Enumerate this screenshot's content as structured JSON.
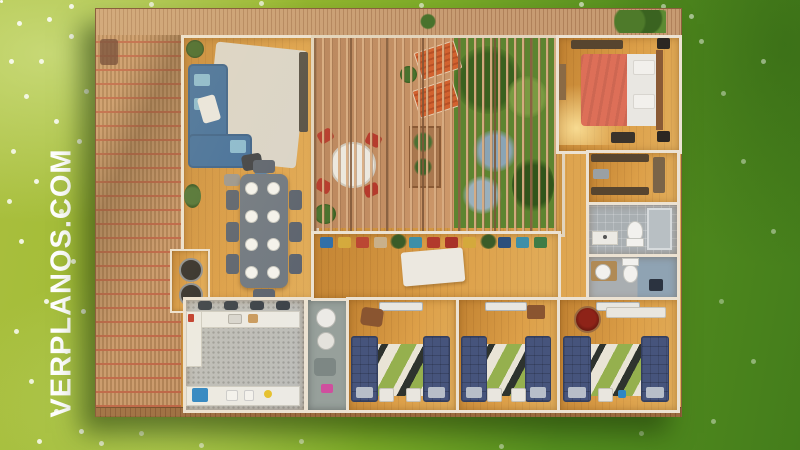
{
  "watermark": {
    "text": "VERPLANOS.COM",
    "color": "#ffffff"
  },
  "scene": {
    "type": "aerial-3d-floor-plan-render",
    "setting": "green lawn with white wildflowers, brighter yellow-green at left, darker green at right",
    "house": {
      "exterior_features": [
        "slatted wood deck strip along top",
        "terracotta trellis pergola deck on left",
        "rear wood deck edge along bottom",
        "central courtyard covered by wood slat pergola with garden"
      ],
      "rooms": [
        {
          "name": "living-room",
          "contents": [
            "blue L-shaped sofa",
            "light area rug",
            "tv wall unit",
            "dark armchair",
            "potted plants"
          ]
        },
        {
          "name": "dining-area",
          "contents": [
            "gray rectangular table",
            "8 white place settings",
            "8 gray chairs",
            "potted plants",
            "bbq nook with grill"
          ]
        },
        {
          "name": "kitchen",
          "contents": [
            "terrazzo floor",
            "white L-shaped counter",
            "4 dark bar stools",
            "bottom counter with blue cabinet",
            "small appliances"
          ]
        },
        {
          "name": "laundry-bathroom",
          "contents": [
            "white round fixtures",
            "pink towel"
          ]
        },
        {
          "name": "courtyard",
          "contents": [
            "2 orange sun loungers",
            "round white table with 4 red chairs",
            "wood planter",
            "lush garden with blue-gray flowering shrubs"
          ]
        },
        {
          "name": "hallway",
          "contents": [
            "bench with multicolor cushions",
            "white runner rug",
            "potted plants"
          ]
        },
        {
          "name": "master-bedroom",
          "contents": [
            "double bed with coral blanket and white duvet",
            "wood headboard",
            "2 dark nightstands",
            "wardrobe",
            "bench",
            "floor lamp glow"
          ]
        },
        {
          "name": "walk-in-closet",
          "contents": [
            "dark wardrobes",
            "gray bench"
          ]
        },
        {
          "name": "bathroom-1",
          "contents": [
            "sink counter",
            "toilet",
            "glass shower"
          ]
        },
        {
          "name": "bathroom-2",
          "contents": [
            "round sink",
            "toilet",
            "blue tiled shower corner",
            "dark floor drain"
          ]
        },
        {
          "name": "bedroom-1",
          "contents": [
            "2 navy single beds",
            "geometric rug",
            "brown pouf",
            "2 small desks",
            "ac unit"
          ]
        },
        {
          "name": "bedroom-2",
          "contents": [
            "2 navy single beds",
            "geometric rug",
            "brown cabinet",
            "2 small desks",
            "ac unit"
          ]
        },
        {
          "name": "bedroom-3",
          "contents": [
            "2 navy single beds",
            "geometric rug",
            "dark red round chair",
            "white shelf desk",
            "ac unit"
          ]
        }
      ]
    },
    "palette": {
      "grass_light": "#9cba32",
      "grass_dark": "#4e8c1e",
      "deck_wood": "#c59a71",
      "trellis_red": "#ba5c40",
      "floor_wood": "#d1923c",
      "wall_white": "#ece2d2",
      "sofa_blue": "#3e6c9c",
      "bed_coral": "#dd6f58",
      "bed_navy": "#46547c",
      "lounger_orange": "#d2622f",
      "chair_red": "#b5392b",
      "rug_green": "#95b04e",
      "cabinet_blue": "#2f86c4",
      "watermark_white": "#ffffff"
    }
  }
}
